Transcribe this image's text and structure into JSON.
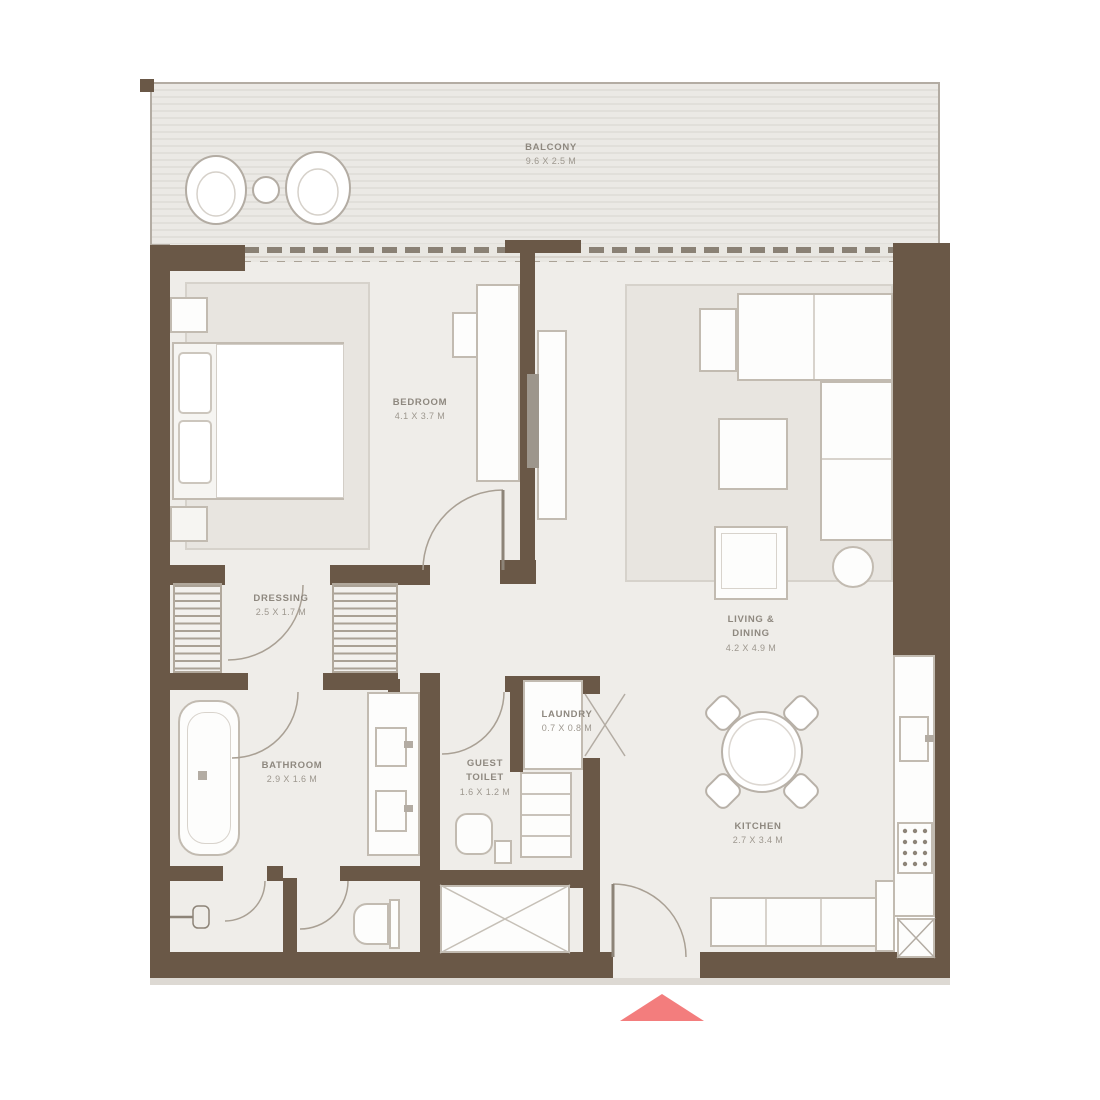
{
  "plan": {
    "colors": {
      "wall": "#6a5847",
      "floor": "#efede9",
      "entry_arrow": "#f37d7d"
    },
    "rooms": {
      "balcony": {
        "name": "BALCONY",
        "dims": "9.6 x 2.5 M"
      },
      "bedroom": {
        "name": "BEDROOM",
        "dims": "4.1 x 3.7 M"
      },
      "living_dining": {
        "line1": "LIVING &",
        "line2": "DINING",
        "dims": "4.2 x 4.9 M"
      },
      "dressing": {
        "name": "DRESSING",
        "dims": "2.5 x 1.7 M"
      },
      "bathroom": {
        "name": "BATHROOM",
        "dims": "2.9 x 1.6 M"
      },
      "guest_toilet": {
        "line1": "GUEST",
        "line2": "TOILET",
        "dims": "1.6 x 1.2 M"
      },
      "laundry": {
        "name": "LAUNDRY",
        "dims": "0.7 x 0.8 M"
      },
      "kitchen": {
        "name": "KITCHEN",
        "dims": "2.7 x 3.4 M"
      }
    }
  }
}
